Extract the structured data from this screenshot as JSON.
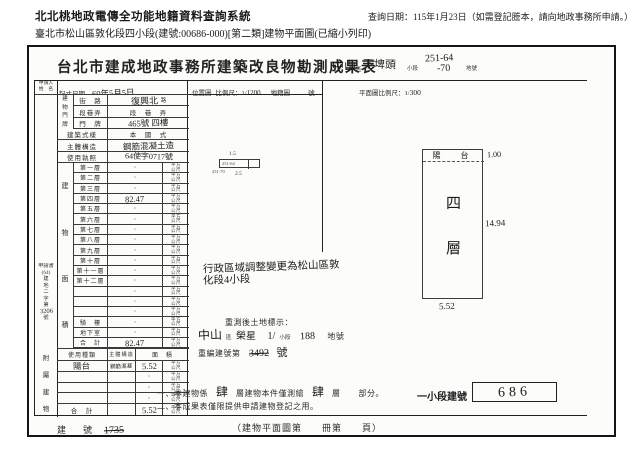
{
  "page": {
    "system_title": "北北桃地政電傳全功能地籍資料查詢系統",
    "query_date": "查詢日期：115年1月23日（如需登記謄本，請向地政事務所申請。）",
    "document_line": "臺北市松山區敦化段四小段(建號:00686-000)[第二類]建物平面圖(已縮小列印)"
  },
  "form": {
    "title": "台北市建成地政事務所建築改良物勘測成果表",
    "fills": {
      "district": "中山",
      "district_suffix": "區",
      "section": "下埤頭",
      "subsection_label": "小段",
      "lot1": "251-64",
      "lot2": "-70",
      "lot_suffix": "地號"
    },
    "head": {
      "applicant1": "申請人",
      "applicant2": "姓　名",
      "survey_label": "起丈日期",
      "survey_value": "60年5月5日",
      "loc_label": "位置圖",
      "scale_label": "比例尺：",
      "scale_num": "1/",
      "scale_den": "1200",
      "cad_label": "地籍圖",
      "no_label": "號",
      "plan_scale_label": "平面圖比例尺：",
      "plan_scale_num": "1/",
      "plan_scale_den": "300"
    },
    "addr": {
      "side": "建物門牌",
      "r1l": "街　路",
      "r1v": "復興北",
      "r1s": "路",
      "r2l": "段巷弄",
      "r2v": "段　巷　弄",
      "r3l": "門　牌",
      "r3v": "465號 四樓"
    },
    "info": {
      "style_label": "建築式樣",
      "style_value": "本　國　式",
      "structure_label": "主體構造",
      "structure_value": "鋼筋混凝土造",
      "license_label": "使用執照",
      "license_value": "64使字0717號"
    },
    "area": {
      "side1": "建",
      "side2": "物",
      "side3": "面",
      "side4": "積",
      "unit1": "平方",
      "unit2": "公尺",
      "rows": [
        {
          "label": "第一層",
          "dot": "·",
          "hw": ""
        },
        {
          "label": "第二層",
          "dot": "·",
          "hw": ""
        },
        {
          "label": "第三層",
          "dot": "·",
          "hw": ""
        },
        {
          "label": "第四層",
          "dot": "",
          "hw": "82.47"
        },
        {
          "label": "第五層",
          "dot": "·",
          "hw": ""
        },
        {
          "label": "第六層",
          "dot": "·",
          "hw": ""
        },
        {
          "label": "第七層",
          "dot": "·",
          "hw": ""
        },
        {
          "label": "第八層",
          "dot": "·",
          "hw": ""
        },
        {
          "label": "第九層",
          "dot": "·",
          "hw": ""
        },
        {
          "label": "第十層",
          "dot": "·",
          "hw": ""
        },
        {
          "label": "第十一層",
          "dot": "·",
          "hw": ""
        },
        {
          "label": "第十二層",
          "dot": "·",
          "hw": ""
        },
        {
          "label": "",
          "dot": "·",
          "hw": ""
        },
        {
          "label": "",
          "dot": "·",
          "hw": ""
        },
        {
          "label": "",
          "dot": "·",
          "hw": ""
        },
        {
          "label": "騎　樓",
          "dot": "·",
          "hw": ""
        },
        {
          "label": "地下室",
          "dot": "·",
          "hw": ""
        },
        {
          "label": "合　計",
          "dot": "",
          "hw": "82.47"
        }
      ]
    },
    "attached": {
      "side1": "附",
      "side2": "屬",
      "side3": "建",
      "side4": "物",
      "h1": "使用種類",
      "h2": "主體構造",
      "h3": "面　積",
      "rows": [
        {
          "use": "陽台",
          "st": "鋼筋混凝",
          "dot": "",
          "hw": "5.52"
        },
        {
          "use": "",
          "st": "",
          "dot": "·",
          "hw": ""
        },
        {
          "use": "",
          "st": "",
          "dot": "·",
          "hw": ""
        },
        {
          "use": "",
          "st": "",
          "dot": "·",
          "hw": ""
        }
      ],
      "total_label": "合　計",
      "total": "5.52"
    },
    "margin": {
      "l1": "申請書",
      "l2": "(64)",
      "c1": "建",
      "c2": "地",
      "c3": "二",
      "c4": "字",
      "c5": "第",
      "num": "3206",
      "l3": "號"
    },
    "locmap": {
      "top": "1.5",
      "inside": "251-64",
      "left": "251-70",
      "bottom": "2.5"
    },
    "plan": {
      "balcony": "陽　台",
      "d_top": "1.00",
      "f1": "四",
      "f2": "層",
      "d_right": "14.94",
      "d_bottom": "5.52"
    },
    "admin": {
      "l1": "行政區域調整變更為松山區敦",
      "l2": "化段4小段"
    },
    "resurvey": {
      "title": "重測後土地標示：",
      "district": "中山",
      "district_suffix": "區",
      "section": "榮星",
      "pre": "1/",
      "ss_label": "小段",
      "lot": "188",
      "lot_suffix": "地號",
      "renumber_label": "重編建號第",
      "renumber_old": "3492",
      "renumber_suffix": "號"
    },
    "notes": {
      "n1a": "一、本建物係",
      "f1": "肆",
      "n1b": "層建物本件僅測繪",
      "f2": "肆",
      "n1c": "層",
      "n1d": "部分。",
      "n2": "二、本成果表僅限提供申請建物登記之用。",
      "seg_label": "一小段建號",
      "seg_value": "686"
    },
    "bottom": {
      "bl": "建　號",
      "bv": "1735",
      "book": "（建物平面圖第　　冊第　　頁）"
    }
  }
}
